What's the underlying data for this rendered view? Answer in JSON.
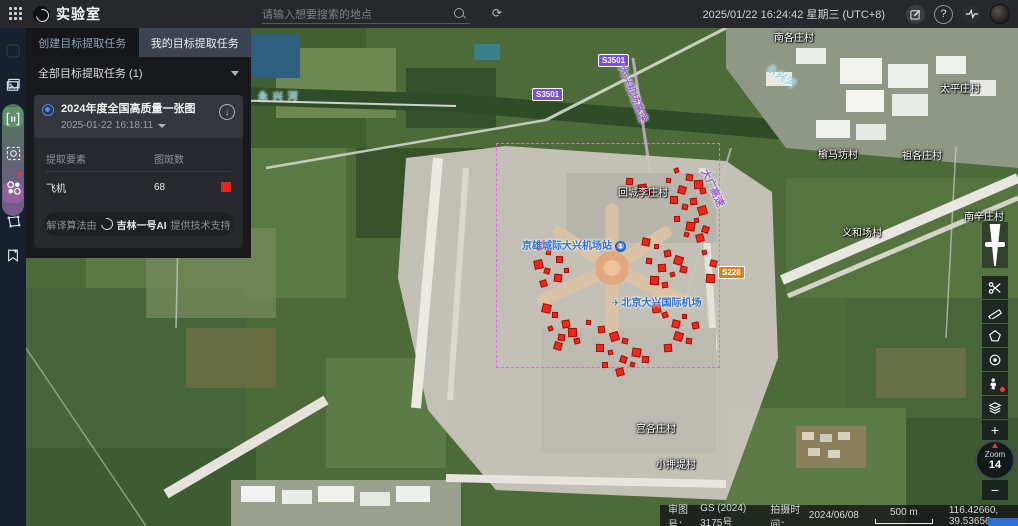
{
  "app": {
    "title": "实验室",
    "datetime": "2025/01/22 16:24:42 星期三 (UTC+8)"
  },
  "search": {
    "placeholder": "请输入想要搜索的地点"
  },
  "tabs": [
    {
      "label": "创建目标提取任务"
    },
    {
      "label": "我的目标提取任务"
    }
  ],
  "filter": {
    "label": "全部目标提取任务 (1)"
  },
  "task": {
    "title": "2024年度全国高质量一张图",
    "datetime": "2025-01-22 16:18:11",
    "col1": "提取要素",
    "col2": "图斑数",
    "rows": [
      {
        "name": "飞机",
        "count": "68",
        "color": "#e8251a"
      }
    ],
    "footer": {
      "prefix": "解译算法由",
      "brand": "吉林一号AI",
      "suffix": "提供技术支持"
    }
  },
  "map": {
    "roi": {
      "x": 470,
      "y": 115,
      "w": 224,
      "h": 225,
      "color": "#e468e4"
    },
    "zoom": {
      "title": "Zoom",
      "level": "14"
    },
    "statusbar": {
      "approval_label": "审图号：",
      "approval": "GS (2024) 3175号",
      "capture_label": "拍摄时间：",
      "capture": "2024/06/08",
      "scale": "500 m",
      "coords": "116.42660, 39.53656"
    },
    "labels": [
      {
        "text": "永 兴 河",
        "type": "water",
        "x": 232,
        "y": 60
      },
      {
        "text": "永兴河",
        "type": "water",
        "x": 740,
        "y": 40,
        "rot": 35
      },
      {
        "text": "南各庄村",
        "type": "village",
        "x": 748,
        "y": 1
      },
      {
        "text": "太平庄村",
        "type": "village",
        "x": 914,
        "y": 52
      },
      {
        "text": "榆马坊村",
        "type": "village",
        "x": 792,
        "y": 118
      },
      {
        "text": "祖各庄村",
        "type": "village",
        "x": 876,
        "y": 119
      },
      {
        "text": "南辛庄村",
        "type": "village",
        "x": 938,
        "y": 180
      },
      {
        "text": "义和场村",
        "type": "village",
        "x": 816,
        "y": 196
      },
      {
        "text": "回城李庄村",
        "type": "village",
        "x": 592,
        "y": 156
      },
      {
        "text": "宫各庄村",
        "type": "village",
        "x": 610,
        "y": 392
      },
      {
        "text": "小押堤村",
        "type": "village",
        "x": 630,
        "y": 428
      },
      {
        "text": "S3501",
        "type": "badge-purple",
        "x": 572,
        "y": 26
      },
      {
        "text": "S3501",
        "type": "badge-purple",
        "x": 506,
        "y": 60
      },
      {
        "text": "S228",
        "type": "badge-orange",
        "x": 692,
        "y": 238
      },
      {
        "text": "大兴机场高速",
        "type": "expwy",
        "x": 578,
        "y": 58,
        "rot": 68
      },
      {
        "text": "大广高速",
        "type": "expwy",
        "x": 668,
        "y": 152,
        "rot": 65
      },
      {
        "text": "京雄城际大兴机场站",
        "type": "poi",
        "x": 496,
        "y": 209,
        "icon": "metro",
        "icon_text": "①"
      },
      {
        "text": "北京大兴国际机场",
        "type": "poi",
        "x": 586,
        "y": 266,
        "icon": "plane",
        "icon_text": "✈"
      }
    ],
    "detections": [
      [
        648,
        140
      ],
      [
        660,
        146
      ],
      [
        668,
        152
      ],
      [
        674,
        160
      ],
      [
        652,
        158
      ],
      [
        640,
        150
      ],
      [
        664,
        170
      ],
      [
        672,
        178
      ],
      [
        656,
        176
      ],
      [
        644,
        168
      ],
      [
        668,
        190
      ],
      [
        676,
        198
      ],
      [
        660,
        194
      ],
      [
        648,
        188
      ],
      [
        670,
        206
      ],
      [
        658,
        204
      ],
      [
        600,
        150
      ],
      [
        612,
        156
      ],
      [
        622,
        162
      ],
      [
        616,
        210
      ],
      [
        628,
        216
      ],
      [
        638,
        222
      ],
      [
        648,
        228
      ],
      [
        620,
        230
      ],
      [
        632,
        236
      ],
      [
        644,
        244
      ],
      [
        654,
        238
      ],
      [
        624,
        248
      ],
      [
        636,
        254
      ],
      [
        510,
        214
      ],
      [
        520,
        222
      ],
      [
        530,
        228
      ],
      [
        508,
        232
      ],
      [
        518,
        240
      ],
      [
        528,
        246
      ],
      [
        538,
        240
      ],
      [
        514,
        252
      ],
      [
        516,
        276
      ],
      [
        526,
        284
      ],
      [
        536,
        292
      ],
      [
        522,
        298
      ],
      [
        532,
        306
      ],
      [
        542,
        300
      ],
      [
        548,
        310
      ],
      [
        528,
        314
      ],
      [
        560,
        292
      ],
      [
        572,
        298
      ],
      [
        584,
        304
      ],
      [
        596,
        310
      ],
      [
        570,
        316
      ],
      [
        582,
        322
      ],
      [
        594,
        328
      ],
      [
        606,
        320
      ],
      [
        576,
        334
      ],
      [
        590,
        340
      ],
      [
        604,
        334
      ],
      [
        616,
        328
      ],
      [
        626,
        276
      ],
      [
        636,
        284
      ],
      [
        646,
        292
      ],
      [
        656,
        286
      ],
      [
        666,
        294
      ],
      [
        648,
        304
      ],
      [
        660,
        310
      ],
      [
        638,
        316
      ],
      [
        676,
        222
      ],
      [
        684,
        232
      ],
      [
        680,
        246
      ]
    ],
    "detection_color": "#ef281b"
  }
}
